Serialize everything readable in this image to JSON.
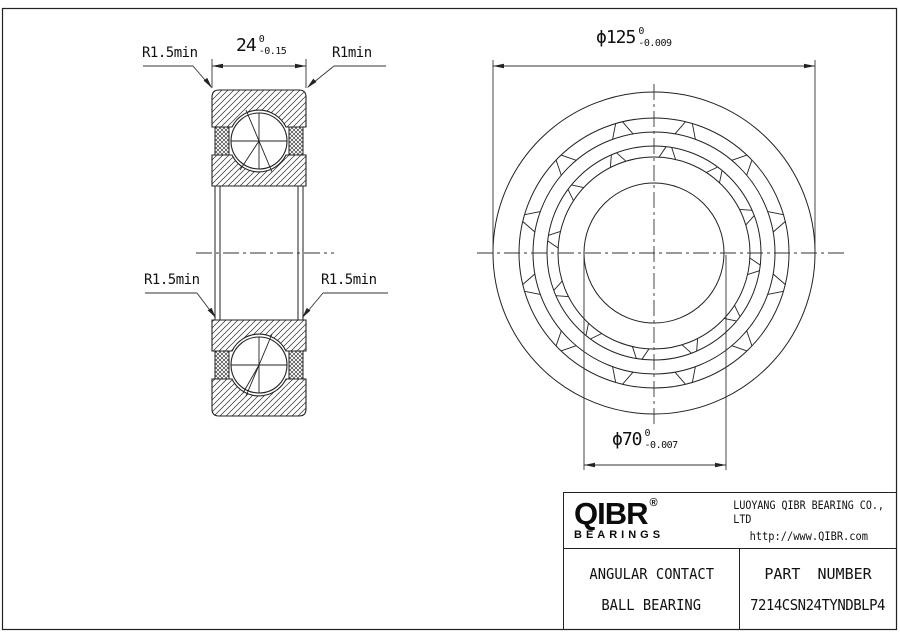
{
  "dimensions": {
    "width": {
      "value": "24",
      "tol_upper": "0",
      "tol_lower": "-0.15"
    },
    "outer_diameter": {
      "prefix": "ϕ",
      "value": "125",
      "tol_upper": "0",
      "tol_lower": "-0.009"
    },
    "bore_diameter": {
      "prefix": "ϕ",
      "value": "70",
      "tol_upper": "0",
      "tol_lower": "-0.007"
    }
  },
  "callouts": {
    "top_left": "R1.5min",
    "top_right": "R1min",
    "bottom_left": "R1.5min",
    "bottom_right": "R1.5min"
  },
  "title_block": {
    "brand": "QIBR",
    "registered_mark": "®",
    "brand_sub": "BEARINGS",
    "company": "LUOYANG QIBR BEARING CO., LTD",
    "website": "http://www.QIBR.com",
    "product_line1": "ANGULAR CONTACT",
    "product_line2": "BALL BEARING",
    "part_number_label": "PART NUMBER",
    "part_number": "7214CSN24TYNDBLP4"
  },
  "colors": {
    "line": "#222222",
    "thin_line": "#333333",
    "text": "#111111",
    "background": "#ffffff"
  }
}
